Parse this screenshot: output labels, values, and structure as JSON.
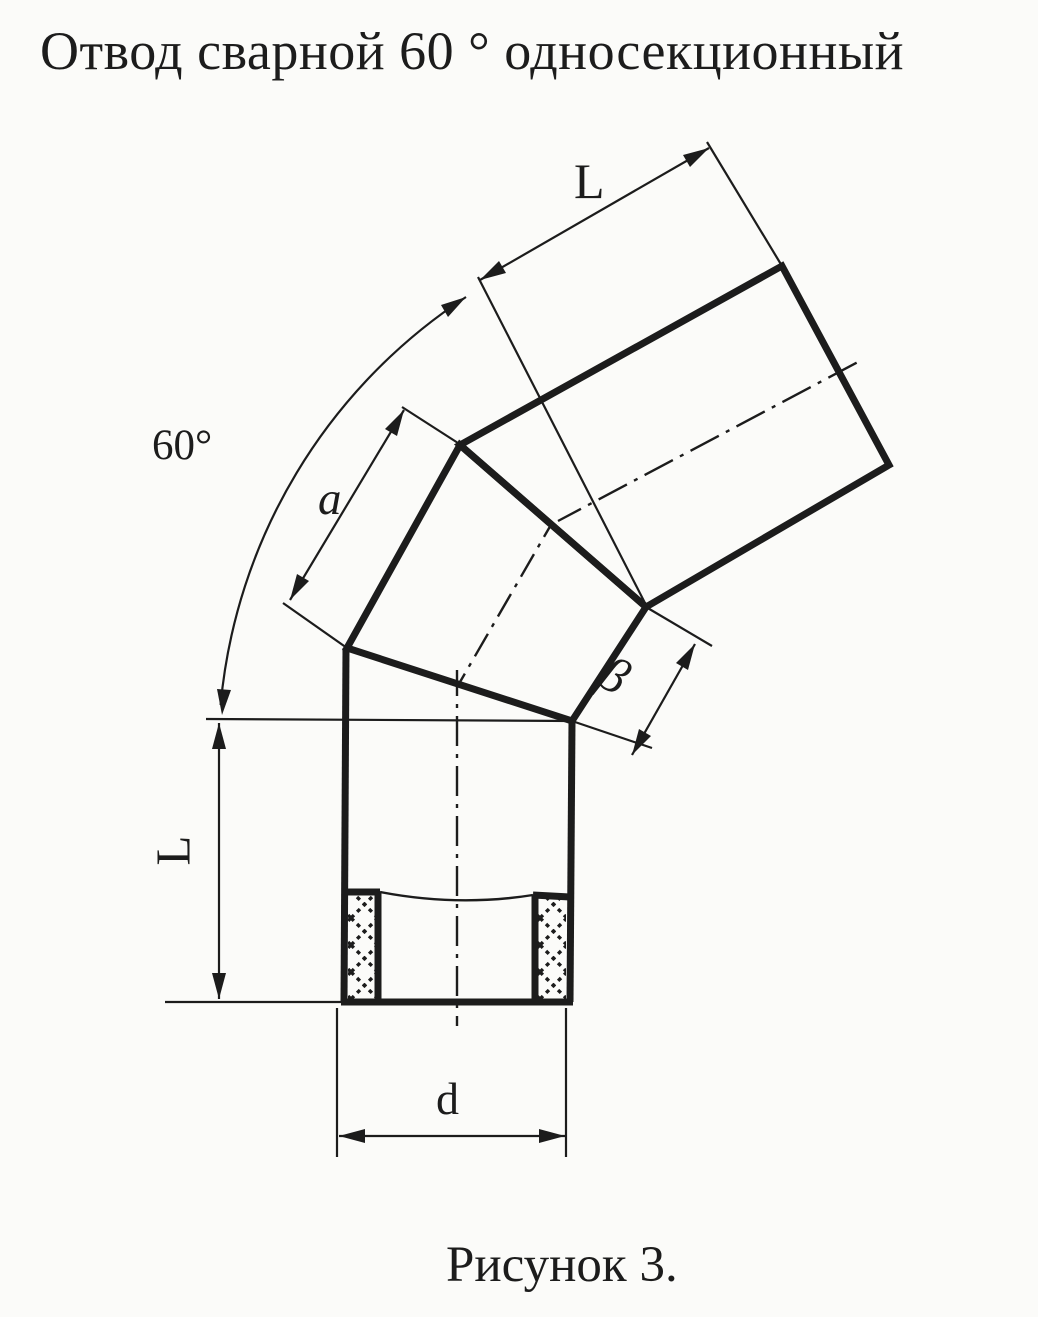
{
  "page": {
    "title": "Отвод сварной 60 ° односекционный",
    "caption": "Рисунок 3."
  },
  "dimension_labels": {
    "bend_angle": "60°",
    "upper_segment_length": "L",
    "section_side": "a",
    "face_width": "β",
    "lower_segment_length": "L",
    "diameter": "d"
  },
  "colors": {
    "ink": "#1c1c1c",
    "background": "#fbfbf9"
  }
}
